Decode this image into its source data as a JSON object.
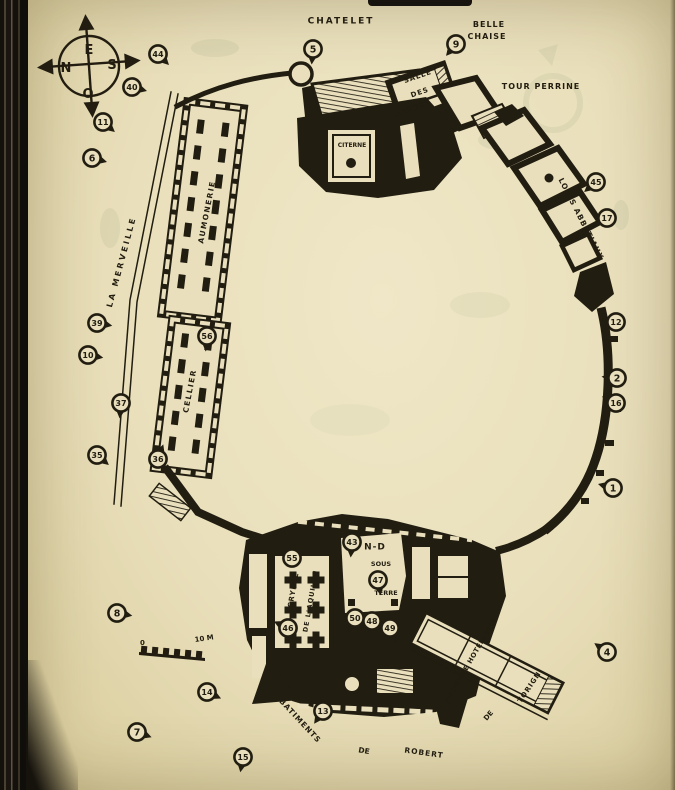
{
  "palette": {
    "paper": "#e9dfbc",
    "ink": "#211d11",
    "ghost": "#8f9b74"
  },
  "compass": {
    "top": "E",
    "left": "N",
    "right": "S",
    "bottom": "O"
  },
  "scale_bar": {
    "zero": "0",
    "ten": "10 M"
  },
  "labels": [
    {
      "id": "chatelet",
      "text": "CHATELET",
      "x": 341,
      "y": 22,
      "rot": 0,
      "size": 9,
      "ls": 2
    },
    {
      "id": "belle",
      "text": "BELLE",
      "x": 489,
      "y": 25,
      "rot": 0,
      "size": 8,
      "ls": 1
    },
    {
      "id": "chaise",
      "text": "CHAISE",
      "x": 487,
      "y": 37,
      "rot": 0,
      "size": 8,
      "ls": 1
    },
    {
      "id": "tour-perrine",
      "text": "TOUR PERRINE",
      "x": 541,
      "y": 87,
      "rot": 0,
      "size": 8,
      "ls": 1
    },
    {
      "id": "salle",
      "text": "SALLE",
      "x": 418,
      "y": 77,
      "rot": -19,
      "size": 7,
      "ls": 1
    },
    {
      "id": "des",
      "text": "DES",
      "x": 420,
      "y": 93,
      "rot": -19,
      "size": 7,
      "ls": 1
    },
    {
      "id": "gardes",
      "text": "GARDES",
      "x": 413,
      "y": 109,
      "rot": -22,
      "size": 7,
      "ls": 1
    },
    {
      "id": "logis-abbatiaux",
      "text": "LOGIS ABBATIAUX",
      "x": 581,
      "y": 219,
      "rot": 63,
      "size": 7.5,
      "ls": 1
    },
    {
      "id": "la-merveille",
      "text": "LA MERVEILLE",
      "x": 122,
      "y": 262,
      "rot": -75,
      "size": 8,
      "ls": 2.5
    },
    {
      "id": "aumonerie",
      "text": "AUMONERIE",
      "x": 207,
      "y": 212,
      "rot": -79,
      "size": 7.5,
      "ls": 1.5
    },
    {
      "id": "cellier",
      "text": "CELLIER",
      "x": 190,
      "y": 391,
      "rot": -79,
      "size": 7.5,
      "ls": 1.5
    },
    {
      "id": "citerne",
      "text": "CITERNE",
      "x": 352,
      "y": 146,
      "rot": 0,
      "size": 6,
      "ls": 0
    },
    {
      "id": "nd",
      "text": "N-D",
      "x": 375,
      "y": 548,
      "rot": 0,
      "size": 9,
      "ls": 1
    },
    {
      "id": "sous",
      "text": "SOUS",
      "x": 381,
      "y": 564,
      "rot": 0,
      "size": 6.5,
      "ls": 0
    },
    {
      "id": "terre",
      "text": "TERRE",
      "x": 386,
      "y": 593,
      "rot": 0,
      "size": 6.5,
      "ls": 0
    },
    {
      "id": "crypte",
      "text": "CRYPTE",
      "x": 294,
      "y": 590,
      "rot": -80,
      "size": 7,
      "ls": 1
    },
    {
      "id": "de-laquilon",
      "text": "DE L'AQUILON",
      "x": 311,
      "y": 601,
      "rot": -80,
      "size": 6.5,
      "ls": 1
    },
    {
      "id": "ancienne-hotellerie",
      "text": "ANCIENNE HOTELLERIE",
      "x": 471,
      "y": 661,
      "rot": -60,
      "size": 6.8,
      "ls": 0.5
    },
    {
      "id": "de-torigni-de",
      "text": "DE",
      "x": 489,
      "y": 716,
      "rot": -50,
      "size": 7,
      "ls": 0
    },
    {
      "id": "torigni",
      "text": "TORIGNI",
      "x": 531,
      "y": 686,
      "rot": -56,
      "size": 7,
      "ls": 1
    },
    {
      "id": "batiments",
      "text": "BATIMENTS",
      "x": 300,
      "y": 721,
      "rot": 47,
      "size": 7.5,
      "ls": 1
    },
    {
      "id": "de-robert-de",
      "text": "DE",
      "x": 364,
      "y": 751,
      "rot": 10,
      "size": 7.5,
      "ls": 0
    },
    {
      "id": "robert",
      "text": "ROBERT",
      "x": 424,
      "y": 753,
      "rot": 8,
      "size": 7.5,
      "ls": 1
    }
  ],
  "markers": [
    {
      "n": "44",
      "x": 158,
      "y": 54,
      "dir": 45
    },
    {
      "n": "40",
      "x": 132,
      "y": 87,
      "dir": 15
    },
    {
      "n": "11",
      "x": 103,
      "y": 122,
      "dir": 40
    },
    {
      "n": "6",
      "x": 92,
      "y": 158,
      "dir": 15
    },
    {
      "n": "39",
      "x": 97,
      "y": 323,
      "dir": 10
    },
    {
      "n": "10",
      "x": 88,
      "y": 355,
      "dir": 10
    },
    {
      "n": "37",
      "x": 121,
      "y": 403,
      "dir": 95
    },
    {
      "n": "35",
      "x": 97,
      "y": 455,
      "dir": 40
    },
    {
      "n": "36",
      "x": 158,
      "y": 459,
      "dir": 290
    },
    {
      "n": "56",
      "x": 207,
      "y": 336,
      "dir": 95
    },
    {
      "n": "8",
      "x": 117,
      "y": 613,
      "dir": 10
    },
    {
      "n": "14",
      "x": 207,
      "y": 692,
      "dir": 25
    },
    {
      "n": "7",
      "x": 137,
      "y": 732,
      "dir": 20
    },
    {
      "n": "15",
      "x": 243,
      "y": 757,
      "dir": 100
    },
    {
      "n": "13",
      "x": 323,
      "y": 711,
      "dir": 125
    },
    {
      "n": "5",
      "x": 313,
      "y": 49,
      "dir": 95
    },
    {
      "n": "9",
      "x": 456,
      "y": 44,
      "dir": 130
    },
    {
      "n": "45",
      "x": 596,
      "y": 182,
      "dir": 140
    },
    {
      "n": "17",
      "x": 607,
      "y": 218,
      "dir": 150
    },
    {
      "n": "12",
      "x": 616,
      "y": 322,
      "dir": 190
    },
    {
      "n": "2",
      "x": 617,
      "y": 378,
      "dir": 185
    },
    {
      "n": "16",
      "x": 616,
      "y": 403,
      "dir": 205
    },
    {
      "n": "1",
      "x": 613,
      "y": 488,
      "dir": 195
    },
    {
      "n": "4",
      "x": 607,
      "y": 652,
      "dir": 215
    },
    {
      "n": "43",
      "x": 352,
      "y": 542,
      "dir": 95
    },
    {
      "n": "47",
      "x": 378,
      "y": 580,
      "dir": 80
    },
    {
      "n": "50",
      "x": 355,
      "y": 618,
      "dir": 115
    },
    {
      "n": "48",
      "x": 372,
      "y": 621,
      "dir": 95
    },
    {
      "n": "49",
      "x": 390,
      "y": 628,
      "dir": 70
    },
    {
      "n": "55",
      "x": 292,
      "y": 558,
      "dir": 275
    },
    {
      "n": "46",
      "x": 288,
      "y": 628,
      "dir": 205
    }
  ]
}
